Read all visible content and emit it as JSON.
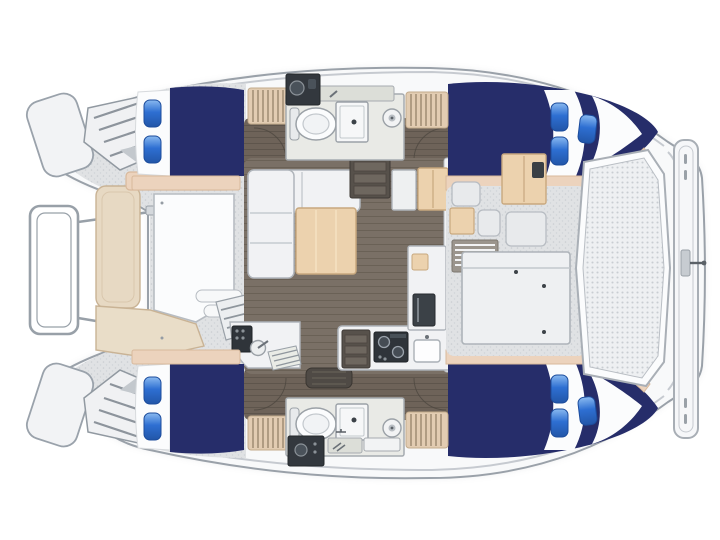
{
  "vessel": {
    "kind": "catamaran-floorplan",
    "view": "top-down",
    "orientation": "bow-left"
  },
  "accommodation": {
    "berths": [
      {
        "id": "forward-port-berth",
        "pillows": 2
      },
      {
        "id": "aft-port-berth",
        "pillows": 3
      },
      {
        "id": "forward-starboard-berth",
        "pillows": 2
      },
      {
        "id": "aft-starboard-berth",
        "pillows": 3
      }
    ],
    "heads": [
      {
        "id": "port-head",
        "fixtures": [
          "vanity-sink",
          "toilet",
          "shower",
          "drain"
        ]
      },
      {
        "id": "starboard-head",
        "fixtures": [
          "vanity-sink",
          "toilet",
          "shower",
          "drain"
        ]
      }
    ],
    "salon": [
      "l-shaped-sofa",
      "wood-table",
      "cabinets",
      "companionway-steps"
    ],
    "galley": [
      "stove",
      "sink",
      "oven",
      "refrigerator",
      "steps"
    ],
    "cockpit": [
      "bench-seats",
      "vent",
      "wet-bar-cabinet",
      "cockpit-table",
      "mesh-deck",
      "transom-gate"
    ],
    "foredeck": [
      "sun-lounger",
      "tan-bench",
      "step-slats",
      "bow-rail",
      "bow-lockers"
    ]
  },
  "colors": {
    "page_bg": "#ffffff",
    "hull_white": "#f8f9fa",
    "hull_outline": "#9aa1a9",
    "deck_gray": "#e0e2e4",
    "deck_dot": "#c9cdd1",
    "sheer_line": "#c6cad0",
    "bed_navy": "#262d6a",
    "pillow_blue": "#2e6fd2",
    "pillow_light": "#8abaf0",
    "linen_white": "#fbfcfd",
    "cushion_tan": "#e7d9c3",
    "shelf_tan": "#ecd3bd",
    "hatch_tan": "#e2ccb2",
    "hatch_line": "#8f7c64",
    "wood_light": "#ecd2ae",
    "wood_line": "#c8a87e",
    "salon_floor": "#7a7066",
    "salon_floor_line": "#6a6156",
    "cabin_floor": "#6e6359",
    "cabin_floor_line": "#5e554c",
    "bath_floor": "#e9eae6",
    "fixture_stroke": "#9ba1a7",
    "counter_gray": "#dcded8",
    "vanity_dark": "#33383e",
    "stove_dark": "#2f343a",
    "steps_dark": "#57514b",
    "furniture_white": "#f1f2f4",
    "furniture_stroke": "#b0b5bb",
    "mesh_bg": "#eef0f2",
    "mesh_dot": "#c9cdd2",
    "frame_stroke": "#a9afb6"
  }
}
